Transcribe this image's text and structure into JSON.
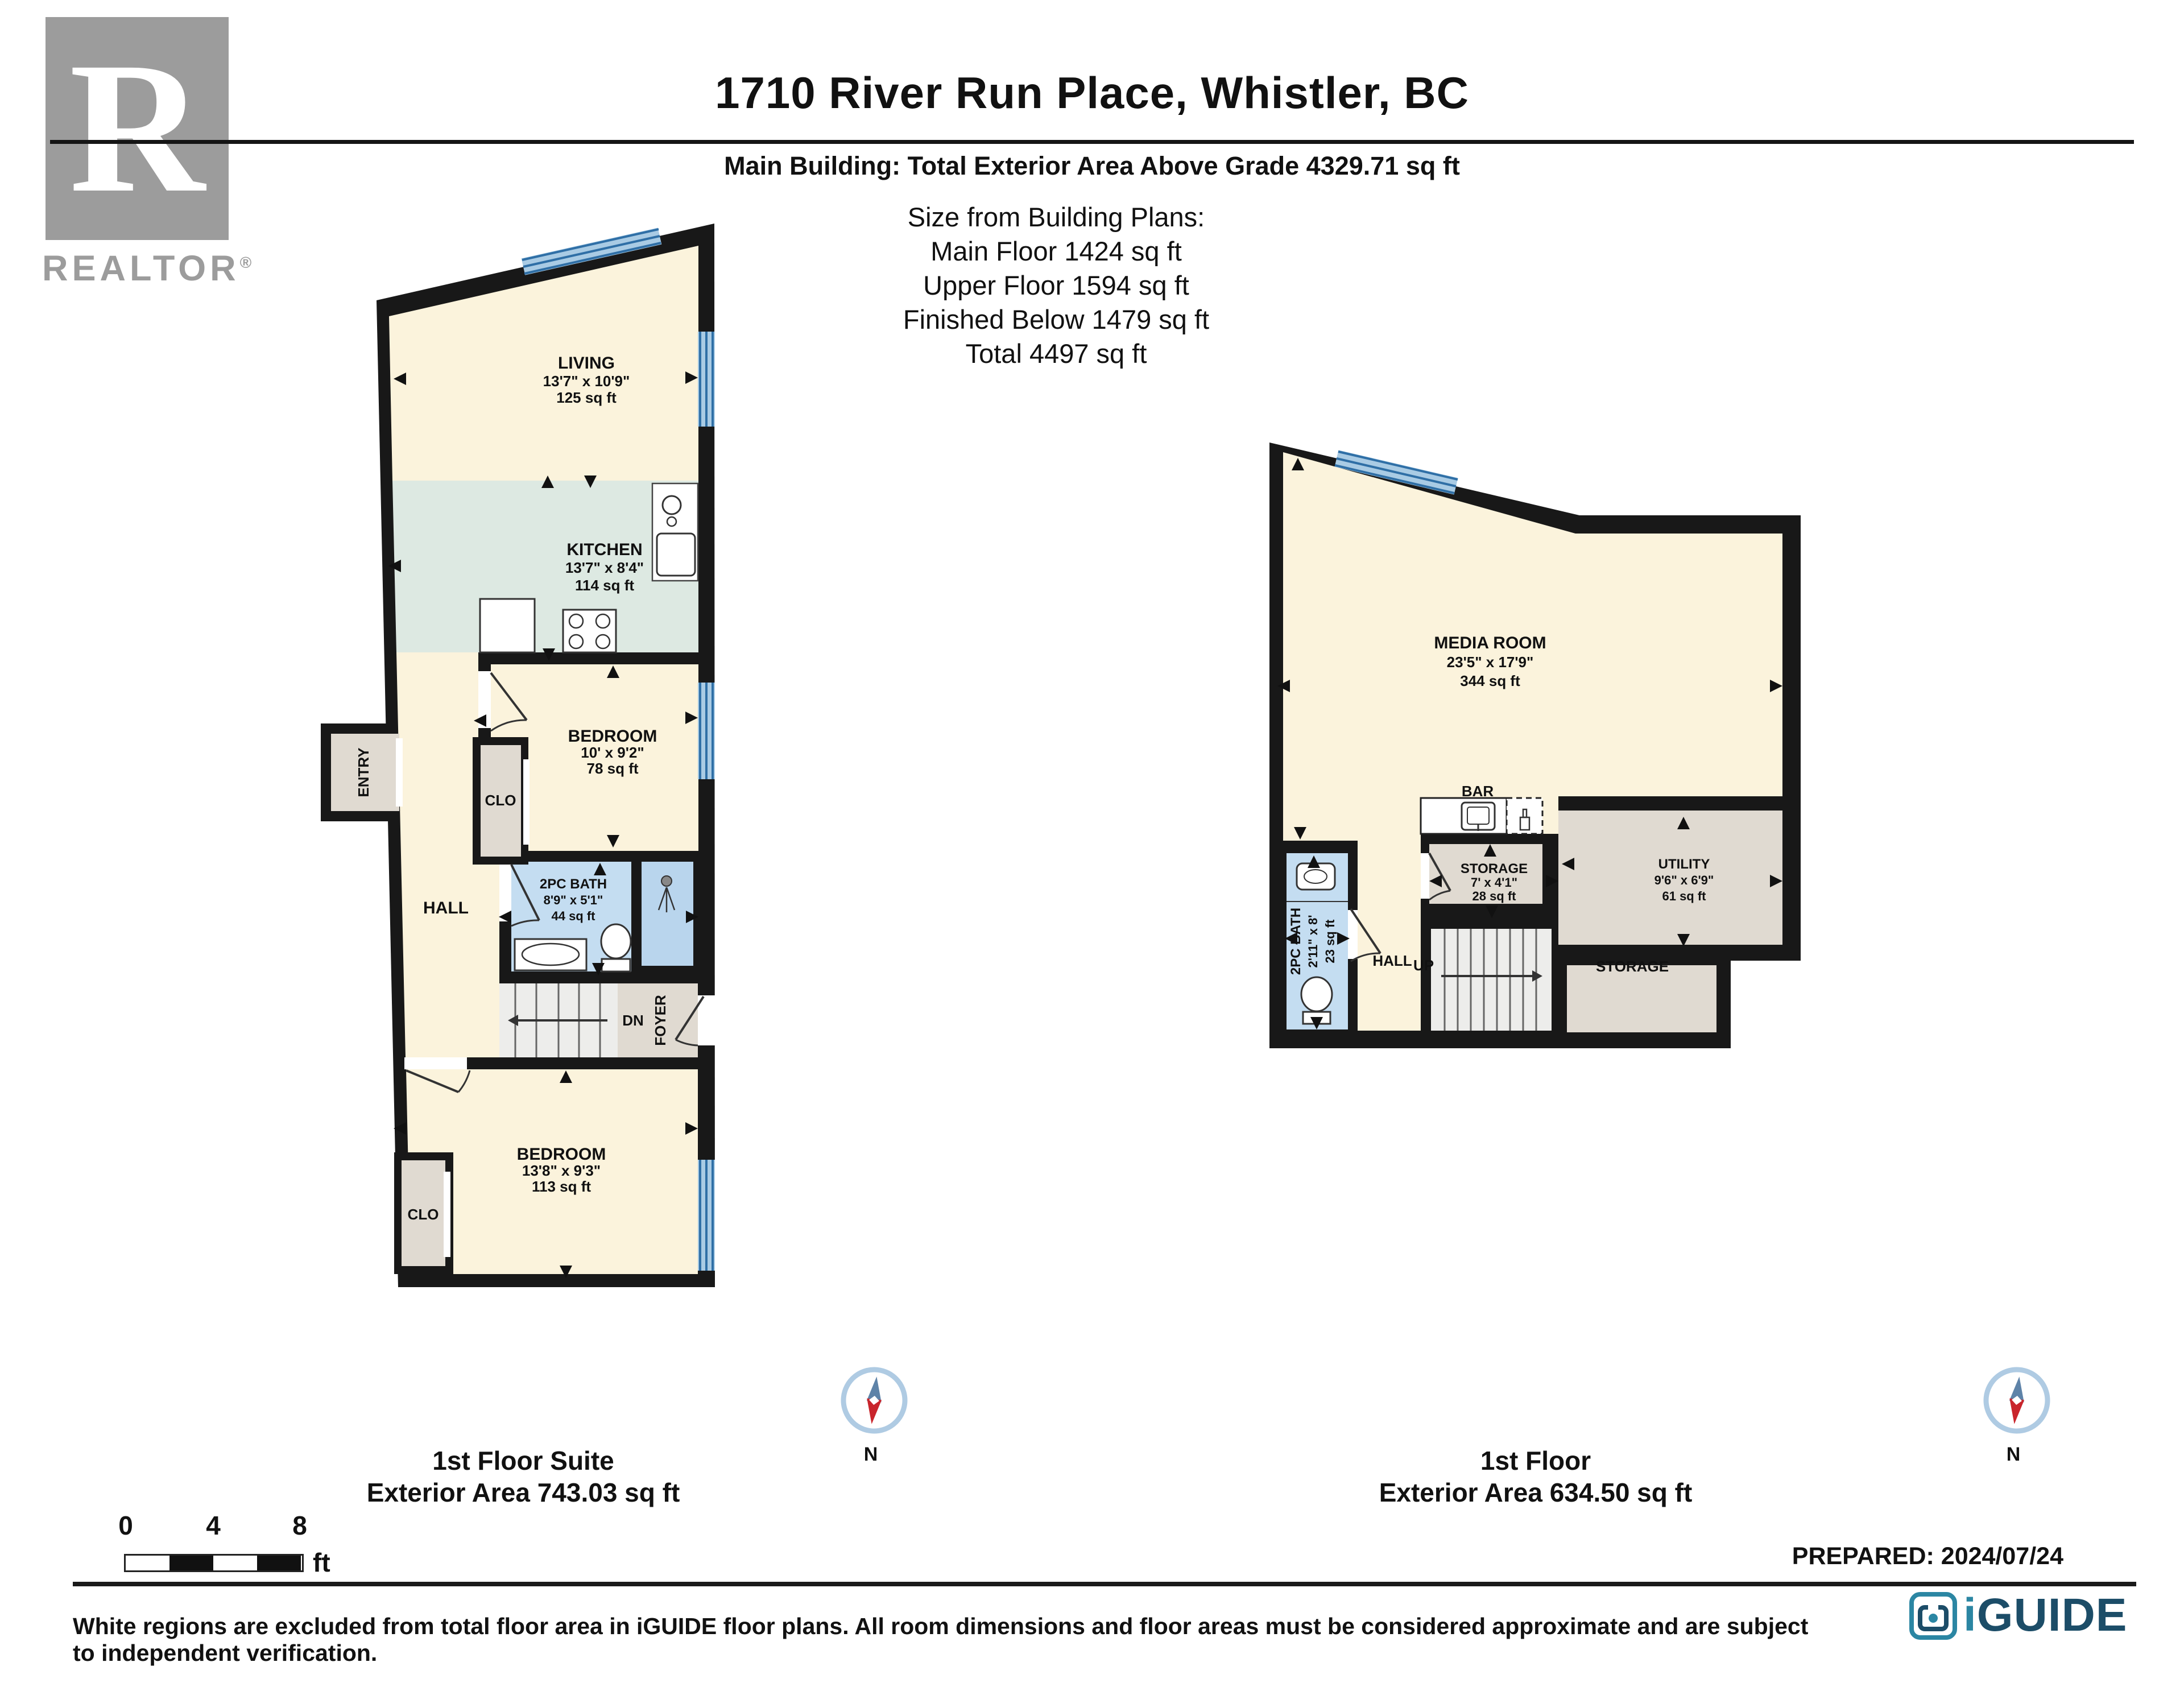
{
  "header": {
    "title": "1710 River Run Place, Whistler, BC",
    "subtitle": "Main Building: Total Exterior Area Above Grade 4329.71 sq ft",
    "size_heading": "Size from Building Plans:",
    "size_lines": [
      "Main Floor 1424 sq ft",
      "Upper Floor 1594 sq ft",
      "Finished Below 1479 sq ft",
      "Total 4497 sq ft"
    ]
  },
  "logos": {
    "realtor_r": "R",
    "realtor_name": "REALTOR",
    "realtor_reg": "®",
    "iguide_i": "i",
    "iguide_rest": "GUIDE"
  },
  "plans": {
    "suite": {
      "caption_title": "1st Floor Suite",
      "caption_area": "Exterior Area 743.03 sq ft",
      "compass": "N",
      "rooms": {
        "living": {
          "name": "LIVING",
          "dims": "13'7\" x 10'9\"",
          "area": "125 sq ft"
        },
        "kitchen": {
          "name": "KITCHEN",
          "dims": "13'7\" x 8'4\"",
          "area": "114 sq ft"
        },
        "bedroom1": {
          "name": "BEDROOM",
          "dims": "10' x 9'2\"",
          "area": "78 sq ft"
        },
        "bath": {
          "name": "2PC BATH",
          "dims": "8'9\" x 5'1\"",
          "area": "44 sq ft"
        },
        "bedroom2": {
          "name": "BEDROOM",
          "dims": "13'8\" x 9'3\"",
          "area": "113 sq ft"
        },
        "hall": {
          "name": "HALL"
        },
        "clo1": {
          "name": "CLO"
        },
        "clo2": {
          "name": "CLO"
        },
        "entry": {
          "name": "ENTRY"
        },
        "foyer": {
          "name": "FOYER"
        },
        "dn": {
          "name": "DN"
        }
      }
    },
    "first": {
      "caption_title": "1st Floor",
      "caption_area": "Exterior Area 634.50 sq ft",
      "compass": "N",
      "rooms": {
        "media": {
          "name": "MEDIA ROOM",
          "dims": "23'5\" x 17'9\"",
          "area": "344 sq ft"
        },
        "bar": {
          "name": "BAR"
        },
        "storage": {
          "name": "STORAGE",
          "dims": "7' x 4'1\"",
          "area": "28 sq ft"
        },
        "utility": {
          "name": "UTILITY",
          "dims": "9'6\" x 6'9\"",
          "area": "61 sq ft"
        },
        "bath": {
          "name": "2PC BATH",
          "dims": "2'11\" x 8'",
          "area": "23 sq ft"
        },
        "hall": {
          "name": "HALL"
        },
        "up": {
          "name": "UP"
        },
        "storage2": {
          "name": "STORAGE"
        }
      }
    }
  },
  "scalebar": {
    "zero": "0",
    "four": "4",
    "eight": "8",
    "unit": "ft"
  },
  "footer": {
    "prepared": "PREPARED: 2024/07/24",
    "disclaimer": "White regions are excluded from total floor area in iGUIDE floor plans. All room dimensions and floor areas must be considered approximate and are subject to independent verification."
  },
  "colors": {
    "wall": "#181818",
    "cream": "#FBF3DC",
    "kitchen": "#DDE9E2",
    "bath_blue": "#C4DDF1",
    "shower_blue": "#B9D5ED",
    "grey_room": "#E0DAD1",
    "stairs": "#EDEDEB",
    "window_light": "#A9CBE4",
    "window_dark": "#2F6FA6",
    "iguide_teal": "#2B86A3",
    "iguide_navy": "#1C4D68",
    "realtor_grey": "#9C9C9C",
    "compass_red": "#C9252C",
    "compass_blue": "#5E83A8"
  }
}
